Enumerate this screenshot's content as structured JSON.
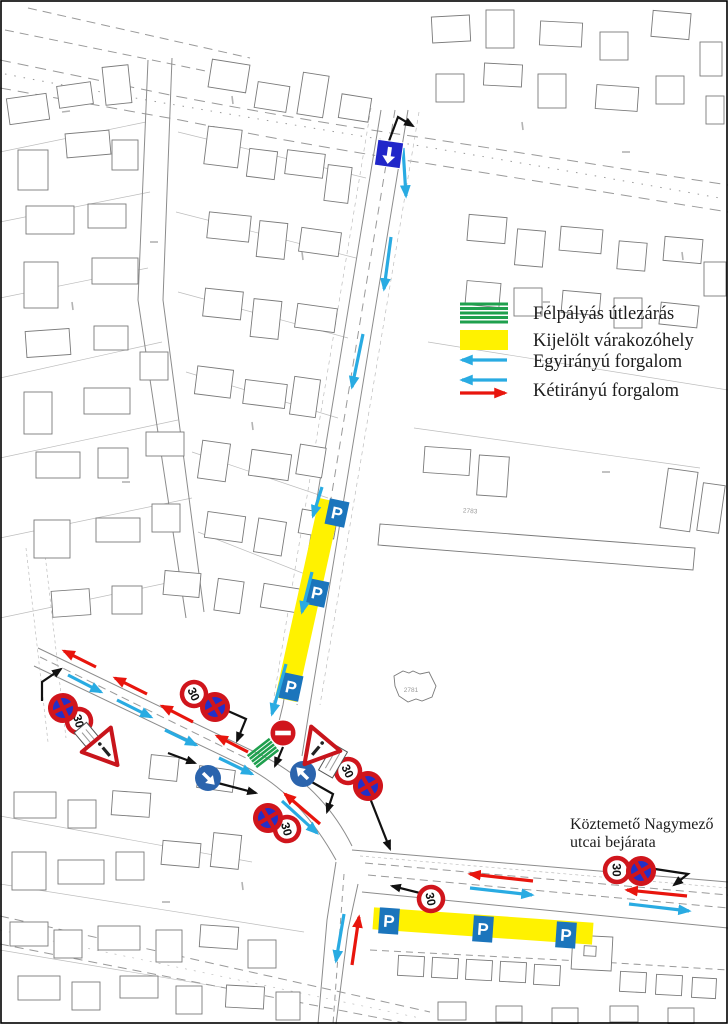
{
  "map": {
    "legend": {
      "items": [
        {
          "label": "Félpályás útlezárás",
          "swatch": "green-stripes",
          "color": "#1FA04E"
        },
        {
          "label": "Kijelölt várakozóhely",
          "swatch": "yellow-rect",
          "color": "#FFF200"
        },
        {
          "label": "Egyirányú forgalom",
          "swatch": "blue-arrow-left",
          "color": "#29ABE2"
        },
        {
          "label": "Kétirányú forgalom",
          "swatch": "blue-and-red-arrows",
          "colors": [
            "#29ABE2",
            "#E8150D"
          ]
        }
      ]
    },
    "annotation": {
      "line1": "Köztemető Nagymező",
      "line2": "utcai bejárata"
    },
    "sign_labels": {
      "speed_limit": "30",
      "parking": "P"
    },
    "parcel_labels": {
      "strip": "2783",
      "church": "2781"
    },
    "colors": {
      "one_way_arrow": "#29ABE2",
      "two_way_arrow_red": "#E8150D",
      "closure_green": "#1FA04E",
      "parking_yellow": "#FFF200",
      "sign_red": "#D0151C",
      "sign_blue_fill": "#2230C8",
      "parking_sign_blue": "#1B75BC",
      "mandatory_sign_blue": "#2B64AD"
    }
  }
}
